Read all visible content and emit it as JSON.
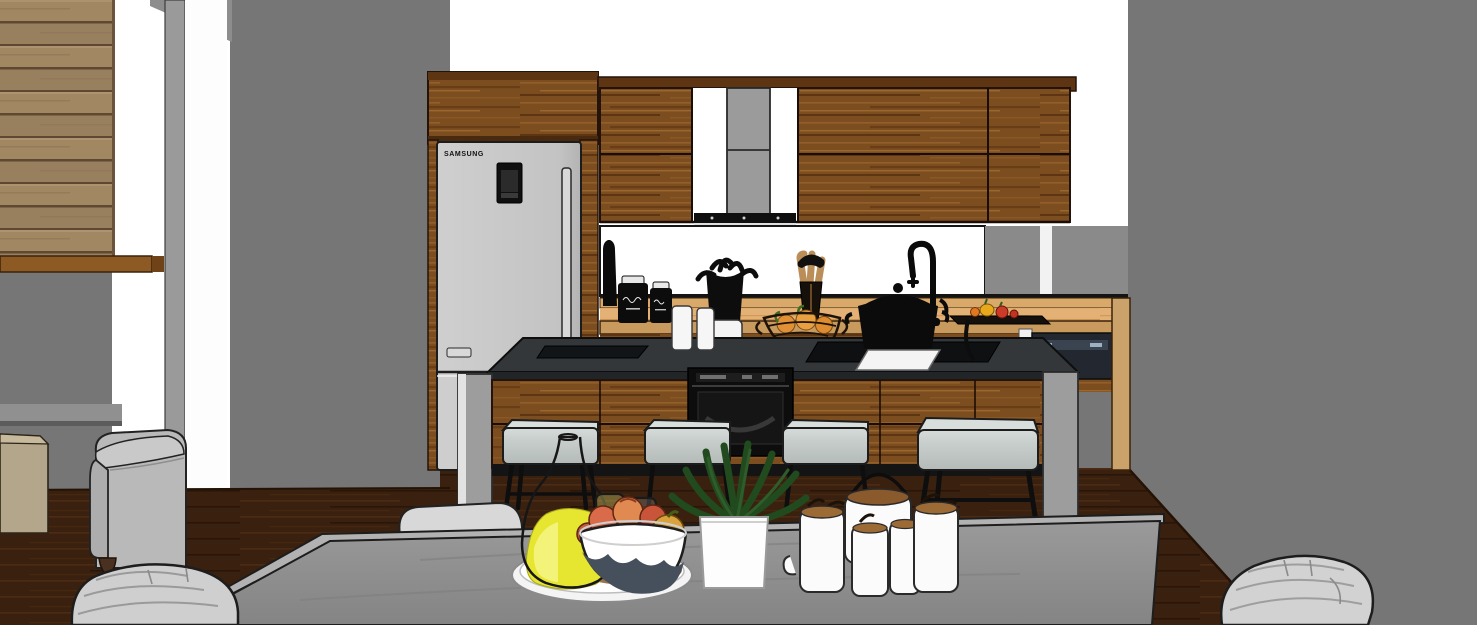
{
  "scene": {
    "type": "3d-interior-render",
    "description": "SketchUp-style flat-shaded render of a modern kitchen with island and concrete dining table, viewed from the dining area",
    "walls": {
      "left": "horizontal wood slat panelling",
      "center_and_right": "plain dark gray",
      "kitchen_back": "white with window backsplash"
    },
    "floor": "dark walnut wood"
  },
  "kitchen": {
    "refrigerator": {
      "brand_label": "SAMSUNG",
      "style": "top-freezer, silver, black door display panel, twin vertical handles",
      "color": "#c7c7c7"
    },
    "tall_cabinet_over_fridge": {
      "material": "walnut wood"
    },
    "upper_cabinets": {
      "material": "walnut wood",
      "door_count": 4,
      "center_gap": "range hood niche"
    },
    "range_hood": {
      "type": "chimney hood",
      "chimney_color": "#9b9b9b",
      "canopy_color": "#111111"
    },
    "counter": {
      "material": "light oak",
      "backsplash": "white window band with black rail"
    },
    "dishwasher": {
      "location": "under right counter",
      "panel_color": "#232830"
    },
    "island": {
      "top_color": "#33373a",
      "front": "walnut drawer fronts",
      "end_panels": "light gray",
      "built_in_oven": true,
      "cooktop": true,
      "sink_cutout": true,
      "white_square_plate": true
    },
    "bar_stools": {
      "count": 4,
      "cushion_color": "#c7cecc",
      "legs": "black metal"
    },
    "counter_items": [
      "dark bottle",
      "black chalk-script canister (large)",
      "black chalk-script canister (small)",
      "two white canisters",
      "white crock with black utensils",
      "wooden spoon holder",
      "wire basket with oranges",
      "black pot on cooktop",
      "black gooseneck faucet",
      "cutting board with bell peppers and tomato"
    ],
    "canister_label_style": "illegible white cursive chalk script"
  },
  "dining": {
    "table": {
      "material": "gray concrete slab",
      "edge": "lighter gray rim"
    },
    "chairs": {
      "count_visible": 3,
      "style": "light gray slipcovered",
      "positions": [
        "bottom-left foreground",
        "behind table left",
        "bottom-right foreground"
      ]
    },
    "armchair": {
      "location": "far left",
      "color": "gray fabric",
      "feet": "dark wood"
    },
    "sideboard": {
      "location": "far left wall",
      "color": "beige"
    },
    "table_items": {
      "tray": "round white serving tray",
      "carafe": "glass carafe with yellow juice",
      "glasses_count": 2,
      "fruit_bowl": "white bowl with navy wave band holding apples and peaches",
      "plant": "green houseplant in white cube planter",
      "tea_set": "white teapot with wooden lid and black wire handle plus five white mugs with wooden lids and spoons"
    }
  },
  "palette": {
    "wall_gray": "#767676",
    "wall_white": "#ffffff",
    "slat_wood": "#a28763",
    "cabinet_wood": "#7c4d1f",
    "counter_wood": "#e3b175",
    "fridge_gray": "#c7c7c7",
    "island_top": "#33373a",
    "island_side": "#9d9d9d",
    "stool_cushion": "#c7cecc",
    "table_gray": "#8e8e8e",
    "floor_brown": "#3a210f",
    "juice_yellow": "#e6e52f",
    "plant_green": "#214a1e",
    "fruit_orange": "#e09136",
    "sideboard_beige": "#b3a68b"
  }
}
